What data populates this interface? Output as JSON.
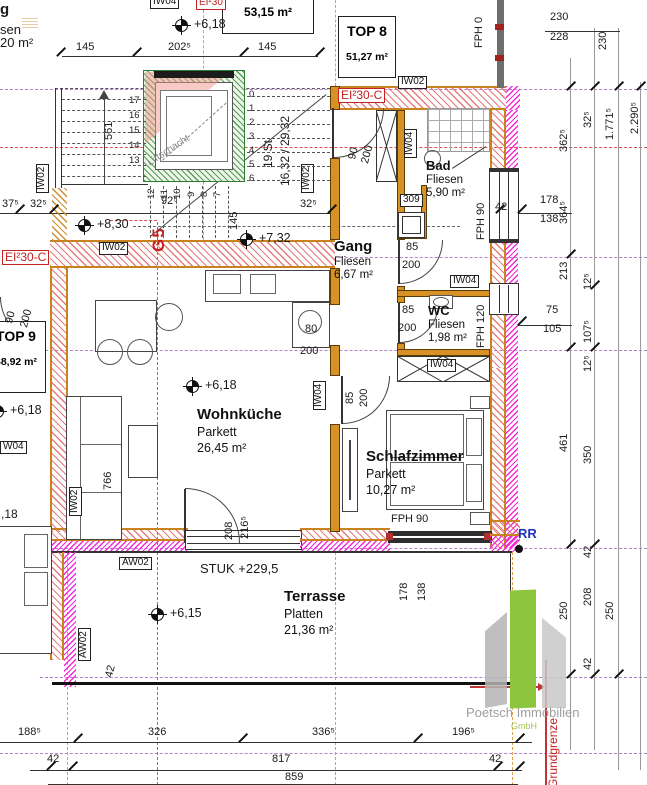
{
  "drawing": {
    "type": "architectural floor plan"
  },
  "apartments": {
    "top8": {
      "name": "TOP 8",
      "area": "51,27 m²"
    },
    "top9": {
      "name": "TOP 9",
      "area": "68,92 m²"
    },
    "adjacent_area": "53,15 m²"
  },
  "rooms": {
    "bad": {
      "name": "Bad",
      "finish": "Fliesen",
      "area": "5,90 m²"
    },
    "gang": {
      "name": "Gang",
      "finish": "Fliesen",
      "area": "6,67 m²"
    },
    "wc": {
      "name": "WC",
      "finish": "Fliesen",
      "area": "1,98 m²"
    },
    "wohnkueche": {
      "name": "Wohnküche",
      "finish": "Parkett",
      "area": "26,45 m²"
    },
    "schlafzimmer": {
      "name": "Schlafzimmer",
      "finish": "Parkett",
      "area": "10,27 m²"
    },
    "terrasse": {
      "name": "Terrasse",
      "finish": "Platten",
      "area": "21,36 m²"
    }
  },
  "logo": {
    "company": "Poetsch Immobilien",
    "legal": "GmbH"
  },
  "colors": {
    "wall_edge": "#c8821e",
    "insulation": "#f32ad8",
    "shaft": "#2f7d32",
    "fire_label": "#c22222",
    "axis": "#b57fd0",
    "boundary": "#c22222"
  },
  "annotations": [
    {
      "t": "145",
      "x": 76,
      "y": 42
    },
    {
      "t": "202⁵",
      "x": 168,
      "y": 42
    },
    {
      "t": "145",
      "x": 258,
      "y": 42
    },
    {
      "t": "230",
      "x": 550,
      "y": 12
    },
    {
      "t": "228",
      "x": 550,
      "y": 32
    },
    {
      "t": "230",
      "x": 598,
      "y": 50,
      "r": -90
    },
    {
      "t": "37⁵",
      "x": 2,
      "y": 199
    },
    {
      "t": "32⁵",
      "x": 30,
      "y": 199
    },
    {
      "t": "92⁵",
      "x": 161,
      "y": 196
    },
    {
      "t": "145",
      "x": 229,
      "y": 230,
      "r": -90
    },
    {
      "t": "32⁵",
      "x": 300,
      "y": 199
    },
    {
      "t": "561",
      "x": 104,
      "y": 140,
      "r": -90
    },
    {
      "t": "90",
      "x": 347,
      "y": 158,
      "r": -75
    },
    {
      "t": "200",
      "x": 360,
      "y": 162,
      "r": -75
    },
    {
      "t": "85",
      "x": 406,
      "y": 242
    },
    {
      "t": "200",
      "x": 402,
      "y": 260
    },
    {
      "t": "85",
      "x": 402,
      "y": 305
    },
    {
      "t": "200",
      "x": 398,
      "y": 323
    },
    {
      "t": "85",
      "x": 345,
      "y": 404,
      "r": -90
    },
    {
      "t": "200",
      "x": 359,
      "y": 407,
      "r": -90
    },
    {
      "t": "80",
      "x": 305,
      "y": 324
    },
    {
      "t": "200",
      "x": 300,
      "y": 346
    },
    {
      "t": "90",
      "x": 4,
      "y": 322,
      "r": -75
    },
    {
      "t": "200",
      "x": 19,
      "y": 326,
      "r": -75
    },
    {
      "t": "766",
      "x": 103,
      "y": 490,
      "r": -90
    },
    {
      "t": "208",
      "x": 224,
      "y": 540,
      "r": -90
    },
    {
      "t": "216⁵",
      "x": 240,
      "y": 539,
      "r": -90
    },
    {
      "t": "362⁵",
      "x": 559,
      "y": 152,
      "r": -90
    },
    {
      "t": "32⁵",
      "x": 583,
      "y": 128,
      "r": -90
    },
    {
      "t": "1.771⁵",
      "x": 605,
      "y": 140,
      "r": -90
    },
    {
      "t": "2.290⁵",
      "x": 630,
      "y": 134,
      "r": -90
    },
    {
      "t": "42",
      "x": 495,
      "y": 202
    },
    {
      "t": "178",
      "x": 540,
      "y": 195
    },
    {
      "t": "138",
      "x": 540,
      "y": 214
    },
    {
      "t": "364⁵",
      "x": 559,
      "y": 224,
      "r": -90
    },
    {
      "t": "213",
      "x": 559,
      "y": 280,
      "r": -90
    },
    {
      "t": "12⁵",
      "x": 583,
      "y": 290,
      "r": -90
    },
    {
      "t": "75",
      "x": 546,
      "y": 305
    },
    {
      "t": "105",
      "x": 543,
      "y": 324
    },
    {
      "t": "107⁵",
      "x": 583,
      "y": 343,
      "r": -90
    },
    {
      "t": "12⁵",
      "x": 583,
      "y": 372,
      "r": -90
    },
    {
      "t": "461",
      "x": 559,
      "y": 452,
      "r": -90
    },
    {
      "t": "350",
      "x": 583,
      "y": 464,
      "r": -90
    },
    {
      "t": "42",
      "x": 583,
      "y": 558,
      "r": -90
    },
    {
      "t": "178",
      "x": 399,
      "y": 601,
      "r": -90
    },
    {
      "t": "138",
      "x": 417,
      "y": 601,
      "r": -90
    },
    {
      "t": "250",
      "x": 559,
      "y": 620,
      "r": -90
    },
    {
      "t": "208",
      "x": 583,
      "y": 606,
      "r": -90
    },
    {
      "t": "250",
      "x": 605,
      "y": 620,
      "r": -90
    },
    {
      "t": "42",
      "x": 583,
      "y": 670,
      "r": -90
    },
    {
      "t": "42",
      "x": 104,
      "y": 676,
      "r": -75
    },
    {
      "t": "188⁵",
      "x": 18,
      "y": 727
    },
    {
      "t": "326",
      "x": 148,
      "y": 727
    },
    {
      "t": "336⁵",
      "x": 312,
      "y": 727
    },
    {
      "t": "196⁵",
      "x": 452,
      "y": 727
    },
    {
      "t": "42",
      "x": 47,
      "y": 754
    },
    {
      "t": "817",
      "x": 272,
      "y": 754
    },
    {
      "t": "42",
      "x": 489,
      "y": 754
    },
    {
      "t": "859",
      "x": 285,
      "y": 772
    },
    {
      "t": "17",
      "x": 129,
      "y": 96,
      "c": "sn"
    },
    {
      "t": "16",
      "x": 129,
      "y": 111,
      "c": "sn"
    },
    {
      "t": "15",
      "x": 129,
      "y": 126,
      "c": "sn"
    },
    {
      "t": "14",
      "x": 129,
      "y": 141,
      "c": "sn"
    },
    {
      "t": "13",
      "x": 129,
      "y": 156,
      "c": "sn"
    },
    {
      "t": "12",
      "x": 147,
      "y": 199,
      "r": -90,
      "c": "sn"
    },
    {
      "t": "11",
      "x": 160,
      "y": 199,
      "r": -90,
      "c": "sn"
    },
    {
      "t": "10",
      "x": 173,
      "y": 199,
      "r": -90,
      "c": "sn"
    },
    {
      "t": "9",
      "x": 187,
      "y": 197,
      "r": -90,
      "c": "sn"
    },
    {
      "t": "8",
      "x": 200,
      "y": 197,
      "r": -90,
      "c": "sn"
    },
    {
      "t": "7",
      "x": 213,
      "y": 197,
      "r": -90,
      "c": "sn"
    },
    {
      "t": "0",
      "x": 249,
      "y": 90,
      "c": "sn"
    },
    {
      "t": "1",
      "x": 249,
      "y": 104,
      "c": "sn"
    },
    {
      "t": "2",
      "x": 249,
      "y": 118,
      "c": "sn"
    },
    {
      "t": "3",
      "x": 249,
      "y": 132,
      "c": "sn"
    },
    {
      "t": "4",
      "x": 249,
      "y": 146,
      "c": "sn"
    },
    {
      "t": "5",
      "x": 249,
      "y": 160,
      "c": "sn"
    },
    {
      "t": "6",
      "x": 249,
      "y": 174,
      "c": "sn"
    },
    {
      "t": "IW04",
      "x": 150,
      "y": -4,
      "c": "tag"
    },
    {
      "t": "IW02",
      "x": 398,
      "y": 76,
      "c": "tag"
    },
    {
      "t": "IW02",
      "x": 99,
      "y": 242,
      "c": "tag"
    },
    {
      "t": "IW04",
      "x": 404,
      "y": 158,
      "r": -90,
      "c": "tag"
    },
    {
      "t": "IW04",
      "x": 450,
      "y": 275,
      "c": "tag"
    },
    {
      "t": "IW04",
      "x": 427,
      "y": 359,
      "c": "tag"
    },
    {
      "t": "IW04",
      "x": 313,
      "y": 410,
      "r": -90,
      "c": "tag"
    },
    {
      "t": "IW02",
      "x": 36,
      "y": 193,
      "r": -90,
      "c": "tag"
    },
    {
      "t": "IW02",
      "x": 301,
      "y": 193,
      "r": -90,
      "c": "tag"
    },
    {
      "t": "IW02",
      "x": 69,
      "y": 516,
      "r": -90,
      "c": "tag"
    },
    {
      "t": "W04",
      "x": 0,
      "y": 441,
      "c": "tag"
    },
    {
      "t": "AW02",
      "x": 119,
      "y": 557,
      "c": "tag"
    },
    {
      "t": "AW02",
      "x": 78,
      "y": 661,
      "r": -90,
      "c": "tag"
    },
    {
      "t": "309",
      "x": 400,
      "y": 194,
      "c": "tag"
    },
    {
      "t": "EI²30-C",
      "x": 2,
      "y": 250,
      "c": "red s12 rbox"
    },
    {
      "t": "EI²30-C",
      "x": 338,
      "y": 88,
      "c": "red s12 rbox"
    },
    {
      "t": "EI²30",
      "x": 196,
      "y": -3,
      "c": "red rbox s10"
    },
    {
      "t": "G5",
      "x": 150,
      "y": 252,
      "r": -90,
      "c": "red g5"
    },
    {
      "t": "Grundgrenze",
      "x": 547,
      "y": 788,
      "r": -90,
      "c": "red s12"
    },
    {
      "t": "Liftschacht",
      "x": 146,
      "y": 160,
      "r": -33,
      "c": "gray2 s10"
    },
    {
      "t": "19 St",
      "x": 262,
      "y": 168,
      "r": -90,
      "c": "s12"
    },
    {
      "t": "16,32 / 29,32",
      "x": 279,
      "y": 186,
      "r": -90,
      "c": "s12"
    },
    {
      "t": "FPH 0",
      "x": 474,
      "y": 48,
      "r": -90
    },
    {
      "t": "FPH 90",
      "x": 476,
      "y": 240,
      "r": -90
    },
    {
      "t": "FPH 120",
      "x": 476,
      "y": 348,
      "r": -90
    },
    {
      "t": "FPH 90",
      "x": 391,
      "y": 514
    },
    {
      "t": "STUK +229,5",
      "x": 200,
      "y": 562,
      "c": "s13"
    },
    {
      "t": "RR",
      "x": 518,
      "y": 527,
      "c": "blue s13"
    },
    {
      "t": "g",
      "x": 0,
      "y": 2,
      "c": "b s15"
    },
    {
      "t": "sen",
      "x": 0,
      "y": 23,
      "c": "s13"
    },
    {
      "t": "20 m²",
      "x": 0,
      "y": 36,
      "c": "s13"
    },
    {
      "t": ",18",
      "x": 1,
      "y": 508,
      "c": "s12"
    },
    {
      "t": "+6,18",
      "x": 194,
      "y": 18,
      "c": "lvl",
      "n": "level-mark-text"
    },
    {
      "t": "+8,30",
      "x": 97,
      "y": 218,
      "c": "lvl",
      "n": "level-mark-text"
    },
    {
      "t": "+7,32",
      "x": 259,
      "y": 232,
      "c": "lvl",
      "n": "level-mark-text"
    },
    {
      "t": "+6,18",
      "x": 10,
      "y": 404,
      "c": "lvl",
      "n": "level-mark-text"
    },
    {
      "t": "+6,18",
      "x": 205,
      "y": 379,
      "c": "lvl",
      "n": "level-mark-text"
    },
    {
      "t": "+6,15",
      "x": 170,
      "y": 607,
      "c": "lvl",
      "n": "level-mark-text"
    }
  ]
}
